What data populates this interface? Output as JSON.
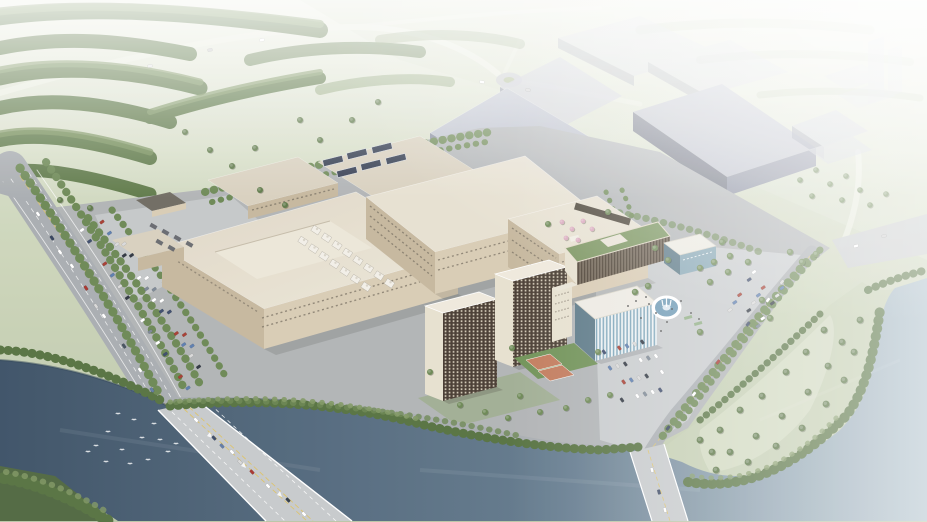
{
  "scene": {
    "description": "Aerial 3D architectural rendering of an industrial campus with beige factory halls, gray future-phase buildings, dormitory towers, a fountain plaza, parking lots, tree-lined roads, and two bridges crossing a dark river; hazy white fade toward the horizon."
  },
  "colors": {
    "field": "#c3cdb0",
    "field_light": "#d8dfc9",
    "field_far": "#e9ecdf",
    "forest": "#5d7847",
    "forest2": "#79925d",
    "tree_dark": "#55713f",
    "tree": "#6b8753",
    "tree_light": "#7f9763",
    "water_deep": "#3b5065",
    "water_mid": "#647b8e",
    "water_light": "#a9bcc7",
    "canal": "#5a7183",
    "road": "#a8acb0",
    "road_light": "#c6c9cb",
    "lane_yellow": "#dcc26a",
    "lane_white": "#ffffff",
    "ground": "#b0b3b5",
    "apron": "#c4c7c8",
    "plaza": "#c8cbcd",
    "beige_roof": "#e7e0d1",
    "beige_roof2": "#d8d0be",
    "beige_wall": "#d8cbb3",
    "beige_wall_dark": "#c5b79d",
    "window": "#6f675a",
    "gray_roof": "#b5b9c6",
    "gray_roof2": "#c7cad5",
    "gray_wall": "#80859a",
    "gray_wall_dark": "#5f6476",
    "gray_faint": "#c9ccd8",
    "dorm": "#493d32",
    "dorm_light": "#e7e0cf",
    "glass": "#5b7886",
    "glass_light": "#87a7b5",
    "green_roof": "#7b9560",
    "court_orange": "#c1795a",
    "court_green": "#6e9055",
    "fountain_water": "#6f9ab5",
    "fountain_rim": "#ffffff",
    "solar": "#323b4f",
    "pink_tree": "#d9a9bd",
    "lawn": "#93a876",
    "bird": "#ffffff",
    "people": "#3c3c3c"
  },
  "scenery": {
    "car_palette": [
      "#ffffff",
      "#3b4a6b",
      "",
      "#a63c30",
      "#5b7cae",
      "#d9d9d9",
      "#2e3540",
      "",
      "#ffffff",
      "#7b8794"
    ],
    "parking_rows": [
      {
        "x1": 82,
        "y1": 230,
        "x2": 188,
        "y2": 388,
        "n": 15,
        "angle": -35,
        "seed": 0
      },
      {
        "x1": 102,
        "y1": 222,
        "x2": 206,
        "y2": 378,
        "n": 15,
        "angle": -35,
        "seed": 3
      },
      {
        "x1": 124,
        "y1": 244,
        "x2": 192,
        "y2": 346,
        "n": 10,
        "angle": -35,
        "seed": 5
      },
      {
        "x1": 604,
        "y1": 352,
        "x2": 650,
        "y2": 340,
        "n": 7,
        "angle": 55,
        "seed": 1
      },
      {
        "x1": 610,
        "y1": 368,
        "x2": 656,
        "y2": 356,
        "n": 7,
        "angle": 55,
        "seed": 4
      },
      {
        "x1": 616,
        "y1": 384,
        "x2": 662,
        "y2": 372,
        "n": 7,
        "angle": 55,
        "seed": 2
      },
      {
        "x1": 622,
        "y1": 400,
        "x2": 668,
        "y2": 388,
        "n": 7,
        "angle": 55,
        "seed": 6
      },
      {
        "x1": 754,
        "y1": 272,
        "x2": 730,
        "y2": 310,
        "n": 6,
        "angle": -35,
        "seed": 0
      },
      {
        "x1": 768,
        "y1": 280,
        "x2": 744,
        "y2": 318,
        "n": 6,
        "angle": -35,
        "seed": 2
      },
      {
        "x1": 782,
        "y1": 288,
        "x2": 758,
        "y2": 326,
        "n": 6,
        "angle": -35,
        "seed": 4
      }
    ],
    "road_cars": [
      [
        38,
        214,
        55,
        "#ffffff"
      ],
      [
        52,
        238,
        55,
        "#32405c"
      ],
      [
        72,
        266,
        55,
        "#ffffff"
      ],
      [
        86,
        288,
        55,
        "#a8332c"
      ],
      [
        104,
        316,
        55,
        "#ffffff"
      ],
      [
        96,
        306,
        55,
        "#d8d8d8"
      ],
      [
        124,
        346,
        55,
        "#44505e"
      ],
      [
        140,
        370,
        55,
        "#ffffff"
      ],
      [
        152,
        390,
        55,
        "#5f7aa6"
      ],
      [
        60,
        252,
        55,
        "#ffffff"
      ],
      [
        196,
        420,
        47,
        "#ffffff"
      ],
      [
        214,
        438,
        47,
        "#3c4a66"
      ],
      [
        232,
        452,
        47,
        "#ffffff"
      ],
      [
        252,
        472,
        47,
        "#a8342c"
      ],
      [
        268,
        486,
        47,
        "#ffffff"
      ],
      [
        288,
        500,
        47,
        "#2f3a46"
      ],
      [
        304,
        514,
        47,
        "#ffffff"
      ],
      [
        240,
        462,
        47,
        "#d9d9d9"
      ],
      [
        222,
        446,
        47,
        "#5f7aa6"
      ],
      [
        768,
        300,
        127,
        "#ffffff"
      ],
      [
        748,
        324,
        127,
        "#3c4a66"
      ],
      [
        718,
        362,
        127,
        "#a8342c"
      ],
      [
        694,
        394,
        127,
        "#ffffff"
      ],
      [
        668,
        428,
        127,
        "#32405c"
      ],
      [
        782,
        282,
        127,
        "#d9d9d9"
      ],
      [
        652,
        470,
        75,
        "#ffffff"
      ],
      [
        659,
        492,
        75,
        "#3c4a66"
      ],
      [
        665,
        510,
        75,
        "#ffffff"
      ],
      [
        150,
        66,
        -12,
        "#e8e8e8"
      ],
      [
        210,
        50,
        -12,
        "#cccccc"
      ],
      [
        262,
        40,
        -12,
        "#ffffff"
      ],
      [
        482,
        82,
        10,
        "#ffffff"
      ],
      [
        528,
        90,
        10,
        "#d0d0d0"
      ],
      [
        856,
        246,
        -15,
        "#ffffff"
      ],
      [
        884,
        236,
        -15,
        "#cfcfcf"
      ]
    ],
    "birds": [
      [
        96,
        446
      ],
      [
        108,
        432
      ],
      [
        122,
        450
      ],
      [
        134,
        420
      ],
      [
        148,
        460
      ],
      [
        160,
        440
      ],
      [
        118,
        414
      ],
      [
        168,
        452
      ],
      [
        142,
        438
      ],
      [
        106,
        462
      ],
      [
        154,
        424
      ],
      [
        130,
        464
      ],
      [
        88,
        452
      ],
      [
        176,
        444
      ]
    ],
    "solar_panels": [
      {
        "x": 333,
        "y": 161
      },
      {
        "x": 357,
        "y": 154
      },
      {
        "x": 382,
        "y": 148
      },
      {
        "x": 347,
        "y": 172
      },
      {
        "x": 371,
        "y": 165
      },
      {
        "x": 396,
        "y": 159
      }
    ],
    "roof_unit_rows": [
      {
        "x": 316,
        "y": 230,
        "n": 8,
        "dx": 10.5,
        "dy": 7.6
      },
      {
        "x": 303,
        "y": 241,
        "n": 7,
        "dx": 10.5,
        "dy": 7.6
      }
    ],
    "people": [
      [
        649,
        304
      ],
      [
        656,
        313
      ],
      [
        641,
        318
      ],
      [
        667,
        322
      ],
      [
        681,
        301
      ],
      [
        691,
        313
      ],
      [
        661,
        331
      ],
      [
        636,
        301
      ],
      [
        699,
        319
      ],
      [
        646,
        297
      ],
      [
        672,
        309
      ],
      [
        628,
        306
      ]
    ],
    "tree_clusters": [
      {
        "c": "tree",
        "r": 3.2,
        "pts": [
          [
            700,
            268
          ],
          [
            714,
            262
          ],
          [
            728,
            272
          ],
          [
            748,
            262
          ],
          [
            710,
            282
          ],
          [
            762,
            300
          ],
          [
            770,
            318
          ],
          [
            700,
            332
          ],
          [
            648,
            286
          ],
          [
            635,
            292
          ],
          [
            790,
            252
          ],
          [
            802,
            262
          ],
          [
            816,
            254
          ],
          [
            722,
            242
          ],
          [
            730,
            256
          ]
        ]
      },
      {
        "c": "tree",
        "r": 3.0,
        "pts": [
          [
            430,
            372
          ],
          [
            460,
            405
          ],
          [
            485,
            412
          ],
          [
            508,
            418
          ],
          [
            540,
            412
          ],
          [
            566,
            408
          ],
          [
            588,
            400
          ],
          [
            610,
            395
          ],
          [
            512,
            348
          ],
          [
            598,
            352
          ],
          [
            520,
            396
          ],
          [
            655,
            248
          ],
          [
            668,
            260
          ],
          [
            548,
            224
          ],
          [
            608,
            212
          ]
        ]
      },
      {
        "c": "forest",
        "r": 3.0,
        "pts": [
          [
            210,
            150
          ],
          [
            232,
            166
          ],
          [
            255,
            148
          ],
          [
            185,
            132
          ],
          [
            300,
            120
          ],
          [
            320,
            140
          ],
          [
            352,
            120
          ],
          [
            378,
            102
          ],
          [
            60,
            200
          ],
          [
            90,
            208
          ],
          [
            260,
            190
          ],
          [
            285,
            205
          ]
        ]
      },
      {
        "c": "tree_dark",
        "r": 3.4,
        "pts": [
          [
            720,
            430
          ],
          [
            740,
            410
          ],
          [
            762,
            396
          ],
          [
            786,
            372
          ],
          [
            806,
            352
          ],
          [
            824,
            330
          ],
          [
            730,
            452
          ],
          [
            756,
            436
          ],
          [
            782,
            416
          ],
          [
            808,
            392
          ],
          [
            828,
            366
          ],
          [
            842,
            342
          ],
          [
            716,
            470
          ],
          [
            748,
            462
          ],
          [
            776,
            446
          ],
          [
            802,
            428
          ],
          [
            826,
            404
          ],
          [
            844,
            380
          ],
          [
            854,
            352
          ],
          [
            860,
            320
          ],
          [
            700,
            440
          ],
          [
            712,
            452
          ]
        ]
      },
      {
        "c": "tree",
        "r": 2.8,
        "pts": [
          [
            800,
            180
          ],
          [
            816,
            170
          ],
          [
            830,
            184
          ],
          [
            846,
            176
          ],
          [
            860,
            190
          ],
          [
            812,
            196
          ],
          [
            842,
            200
          ],
          [
            870,
            205
          ],
          [
            886,
            194
          ]
        ]
      },
      {
        "c": "pink_tree",
        "r": 2.4,
        "pts": [
          [
            562,
            222
          ],
          [
            572,
            229
          ],
          [
            583,
            221
          ],
          [
            592,
            229
          ],
          [
            566,
            238
          ],
          [
            578,
            240
          ]
        ]
      }
    ]
  }
}
